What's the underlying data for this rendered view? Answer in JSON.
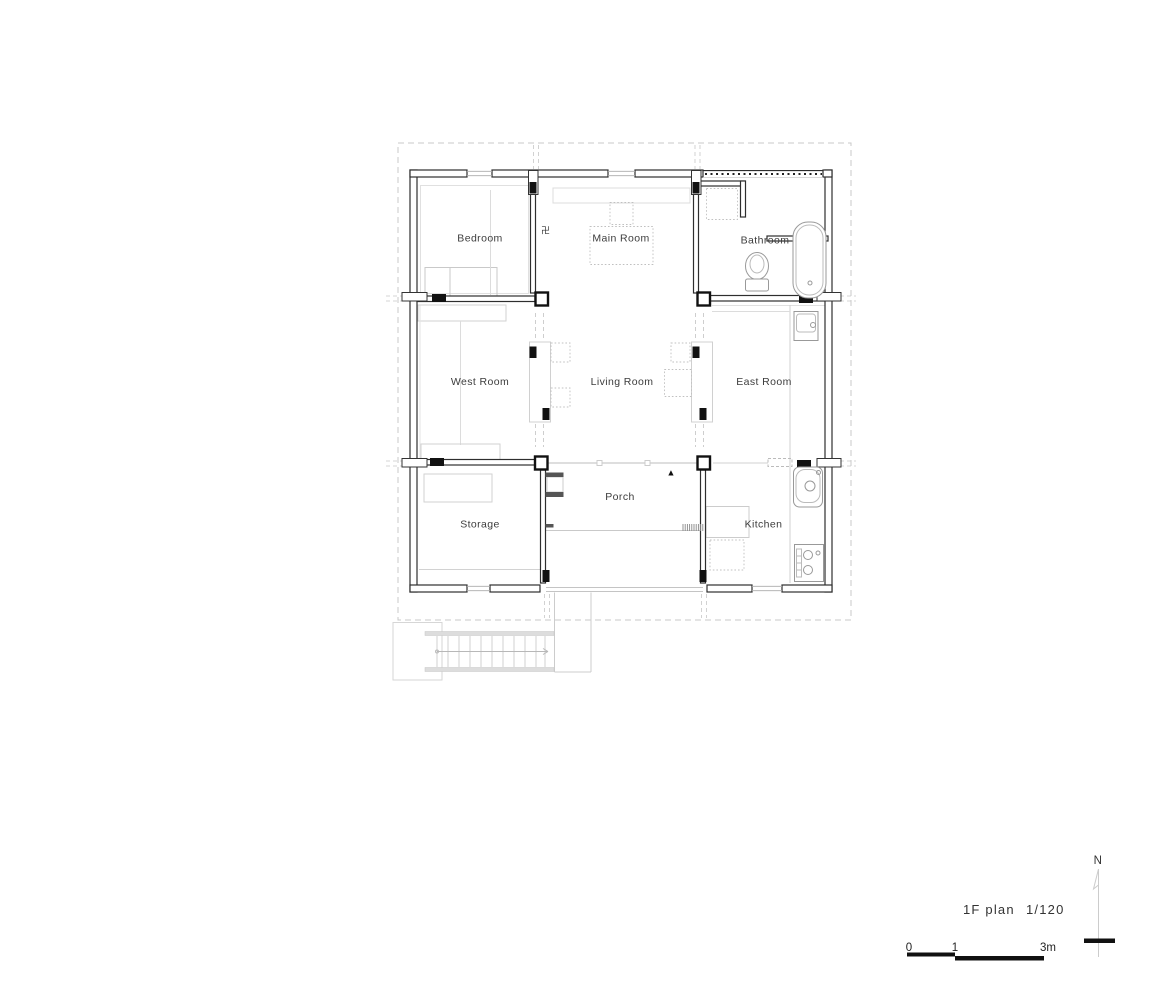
{
  "plan": {
    "rooms": [
      {
        "label": "Bedroom"
      },
      {
        "label": "Main Room"
      },
      {
        "label": "Bathroom"
      },
      {
        "label": "West Room"
      },
      {
        "label": "Living Room"
      },
      {
        "label": "East Room"
      },
      {
        "label": "Storage"
      },
      {
        "label": "Porch"
      },
      {
        "label": "Kitchen"
      }
    ],
    "annotations": {
      "altar_symbol": "卍",
      "entrance_marker": "▲",
      "north_label": "N"
    },
    "title": {
      "floor": "1F plan",
      "scale": "1/120"
    },
    "scalebar": {
      "tick_start": "0",
      "tick_mid": "1",
      "tick_end": "3m"
    },
    "colors": {
      "wall": "#2e2e2e",
      "black": "#111111",
      "light_gray": "#cccccc",
      "eave_dash": "#c8c8c8"
    }
  }
}
